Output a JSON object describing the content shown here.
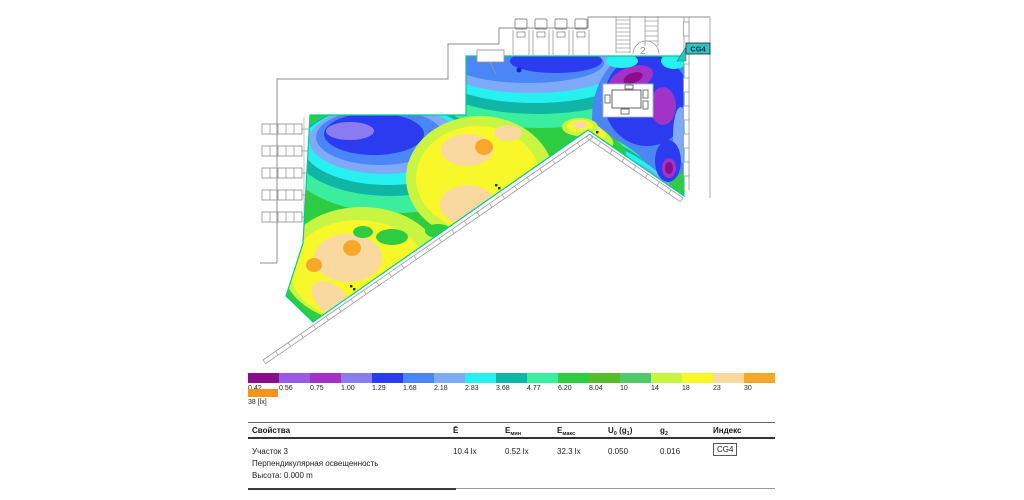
{
  "plan": {
    "tag_label": "CG4",
    "stair_label": "2",
    "tag_color": "#2BC4C0",
    "region_outline_color": "#00CC92"
  },
  "legend": {
    "stops": [
      {
        "label": "0.42",
        "color": "#8A0D8A"
      },
      {
        "label": "0.56",
        "color": "#9B59E8"
      },
      {
        "label": "0.75",
        "color": "#A233C6"
      },
      {
        "label": "1.00",
        "color": "#8A7CF0"
      },
      {
        "label": "1.29",
        "color": "#2B3BF0"
      },
      {
        "label": "1.68",
        "color": "#4A86F5"
      },
      {
        "label": "2.18",
        "color": "#7FAAF8"
      },
      {
        "label": "2.83",
        "color": "#27F0F0"
      },
      {
        "label": "3.68",
        "color": "#0FB5A5"
      },
      {
        "label": "4.77",
        "color": "#3BEE9E"
      },
      {
        "label": "6.20",
        "color": "#2ECC40"
      },
      {
        "label": "8.04",
        "color": "#55BE28"
      },
      {
        "label": "10",
        "color": "#52C96B"
      },
      {
        "label": "14",
        "color": "#C8F542"
      },
      {
        "label": "18",
        "color": "#F7F72A"
      },
      {
        "label": "23",
        "color": "#FAD9A0"
      },
      {
        "label": "30",
        "color": "#F7A82B"
      }
    ],
    "overflow": {
      "label": "38 [lx]",
      "color": "#F7941E"
    }
  },
  "table": {
    "headers": {
      "properties": "Свойства",
      "e_avg": "Ē",
      "e_min_base": "E",
      "e_min_sub": "мин",
      "e_max_base": "E",
      "e_max_sub": "макс",
      "u0_a": "U",
      "u0_b": "0",
      "u0_c": " (g",
      "u0_d": "1",
      "u0_e": ")",
      "g2_base": "g",
      "g2_sub": "2",
      "index": "Индекс"
    },
    "row": {
      "name": "Участок 3",
      "type": "Перпендикулярная освещенность",
      "height": "Высота: 0.000 m",
      "e_avg": "10.4 lx",
      "e_min": "0.52 lx",
      "e_max": "32.3 lx",
      "u0": "0.050",
      "g2": "0.016",
      "index": "CG4"
    }
  }
}
